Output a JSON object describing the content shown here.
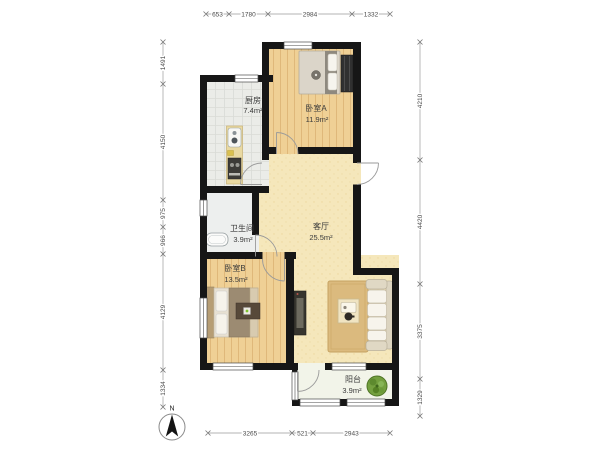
{
  "plan": {
    "rooms": [
      {
        "name": "厨房",
        "area": "7.4m²"
      },
      {
        "name": "卧室A",
        "area": "11.9m²"
      },
      {
        "name": "客厅",
        "area": "25.5m²"
      },
      {
        "name": "卫生间",
        "area": "3.9m²"
      },
      {
        "name": "卧室B",
        "area": "13.5m²"
      },
      {
        "name": "阳台",
        "area": "3.9m²"
      }
    ],
    "dimensions": {
      "top": [
        "653",
        "1780",
        "2984",
        "1332"
      ],
      "left": [
        "1491",
        "4150",
        "975",
        "966",
        "4129",
        "1334"
      ],
      "right": [
        "4210",
        "4420",
        "3375",
        "1329"
      ],
      "bottom": [
        "3265",
        "521",
        "2943"
      ]
    },
    "compass_label": "N",
    "colors": {
      "wall": "#161616",
      "wood_floor": "#efd095",
      "living_floor": "#f5e7bb",
      "kitchen_tile": "#ebece8",
      "rug": "#dbba7e",
      "plant": "#74a03f"
    }
  }
}
